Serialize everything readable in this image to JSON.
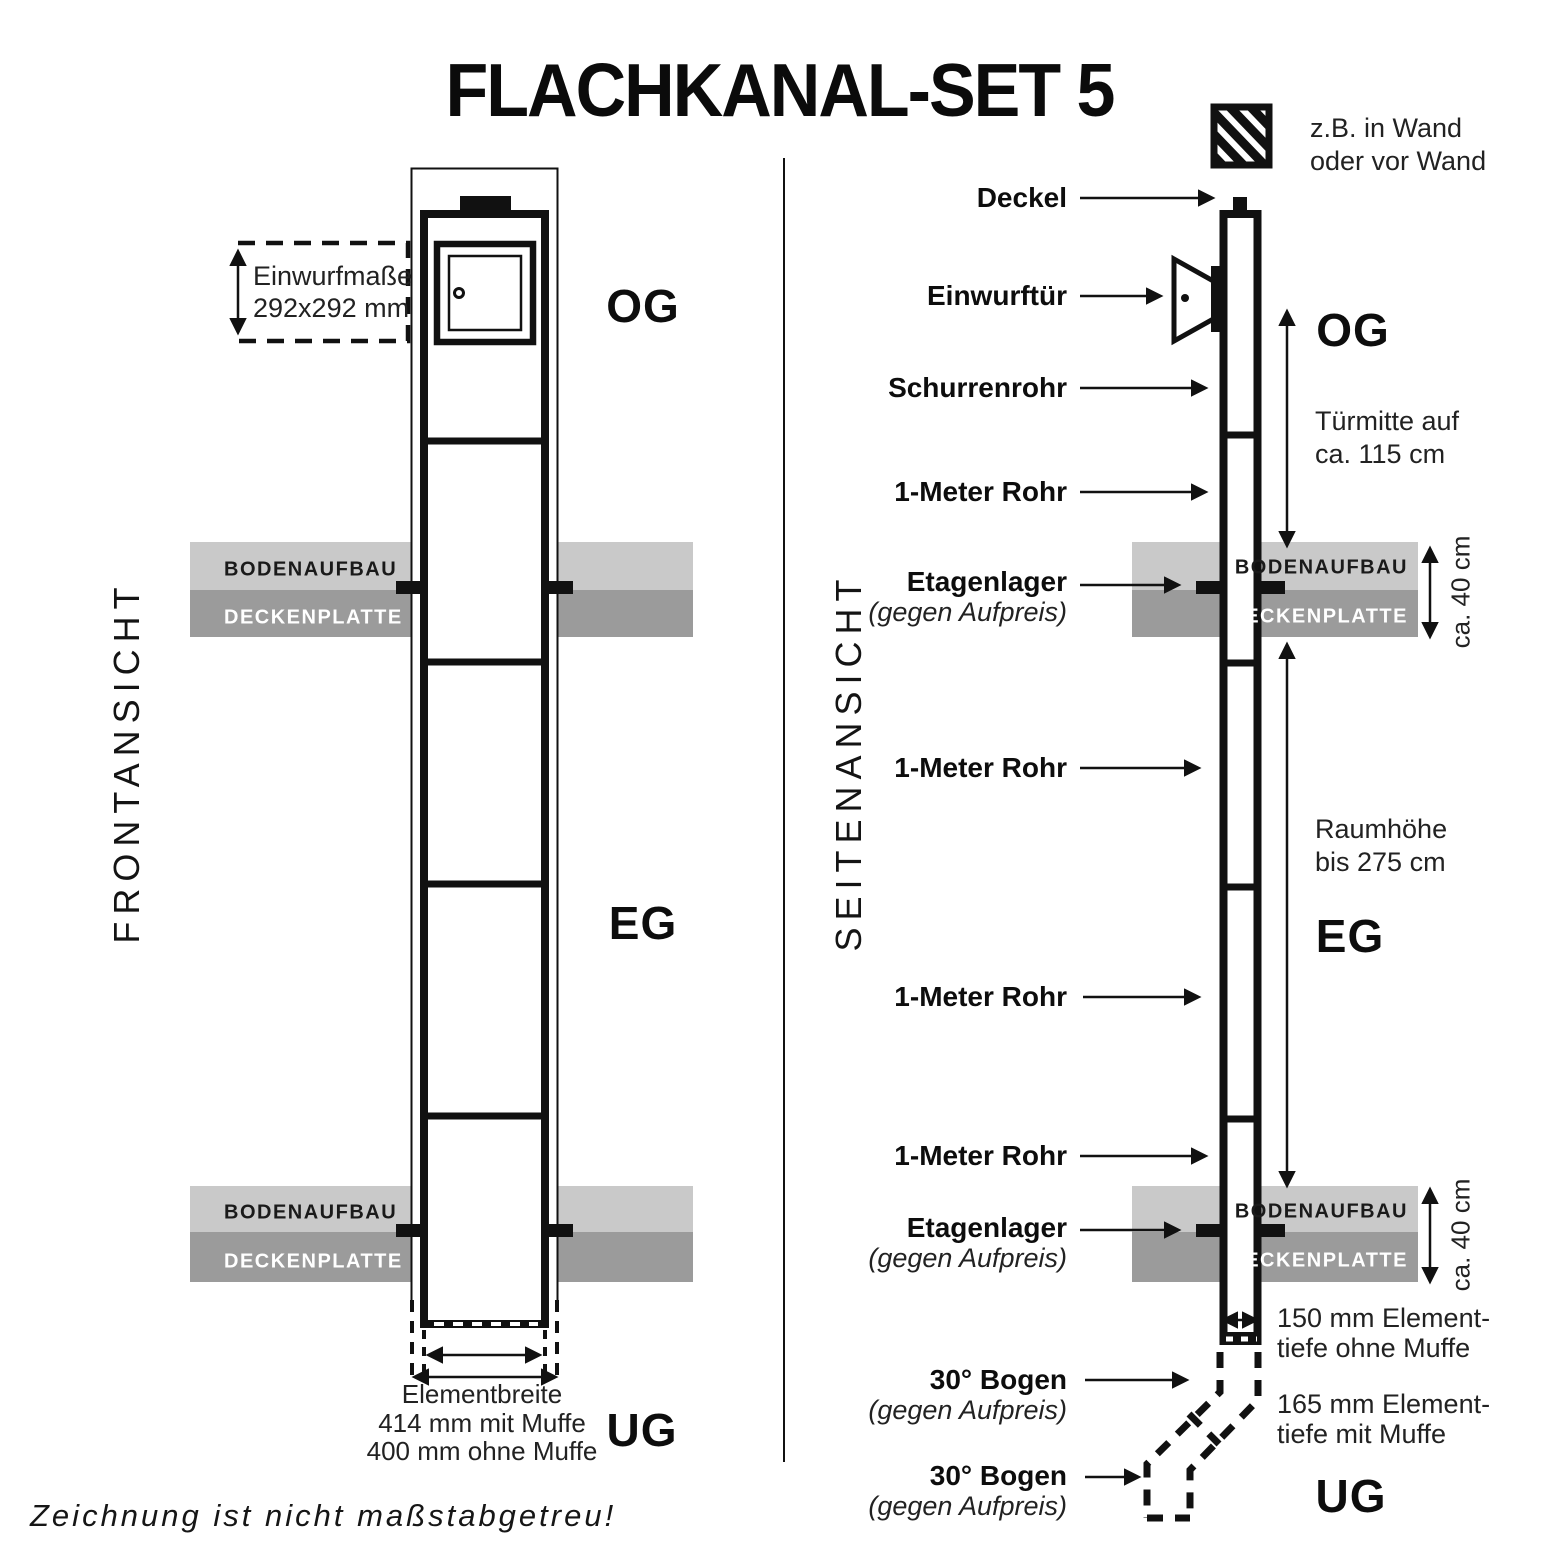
{
  "title": "FLACHKANAL-SET 5",
  "footnote": "Zeichnung ist nicht maßstabgetreu!",
  "colors": {
    "band_light": "#c9c9c9",
    "band_dark": "#9b9b9b",
    "ink": "#111111"
  },
  "bands": {
    "bodenaufbau": "BODENAUFBAU",
    "deckenplatte": "DECKENPLATTE"
  },
  "front": {
    "view_label": "FRONTANSICHT",
    "floor_labels": {
      "og": "OG",
      "eg": "EG",
      "ug": "UG"
    },
    "einwurfmasse": {
      "line1": "Einwurfmaße",
      "line2": "292x292 mm"
    },
    "elementbreite": {
      "line1": "Elementbreite",
      "line2": "414 mm mit Muffe",
      "line3": "400 mm ohne Muffe"
    }
  },
  "side": {
    "view_label": "SEITENANSICHT",
    "floor_labels": {
      "og": "OG",
      "eg": "EG",
      "ug": "UG"
    },
    "wall_note": {
      "line1": "z.B. in Wand",
      "line2": "oder vor Wand"
    },
    "labels": [
      {
        "text": "Deckel"
      },
      {
        "text": "Einwurftür"
      },
      {
        "text": "Schurrenrohr"
      },
      {
        "text": "1-Meter Rohr"
      },
      {
        "text": "Etagenlager",
        "sub": "(gegen Aufpreis)"
      },
      {
        "text": "1-Meter Rohr"
      },
      {
        "text": "1-Meter Rohr"
      },
      {
        "text": "1-Meter Rohr"
      },
      {
        "text": "Etagenlager",
        "sub": "(gegen Aufpreis)"
      },
      {
        "text": "30° Bogen",
        "sub": "(gegen Aufpreis)"
      },
      {
        "text": "30° Bogen",
        "sub": "(gegen Aufpreis)"
      }
    ],
    "dimensions": {
      "tuermitte": {
        "line1": "Türmitte auf",
        "line2": "ca. 115 cm"
      },
      "raumhoehe": {
        "line1": "Raumhöhe",
        "line2": "bis 275 cm"
      },
      "floor_thickness": "ca. 40 cm",
      "depth_no_socket": {
        "line1": "150 mm Element-",
        "line2": "tiefe ohne Muffe"
      },
      "depth_socket": {
        "line1": "165 mm Element-",
        "line2": "tiefe mit Muffe"
      }
    }
  }
}
